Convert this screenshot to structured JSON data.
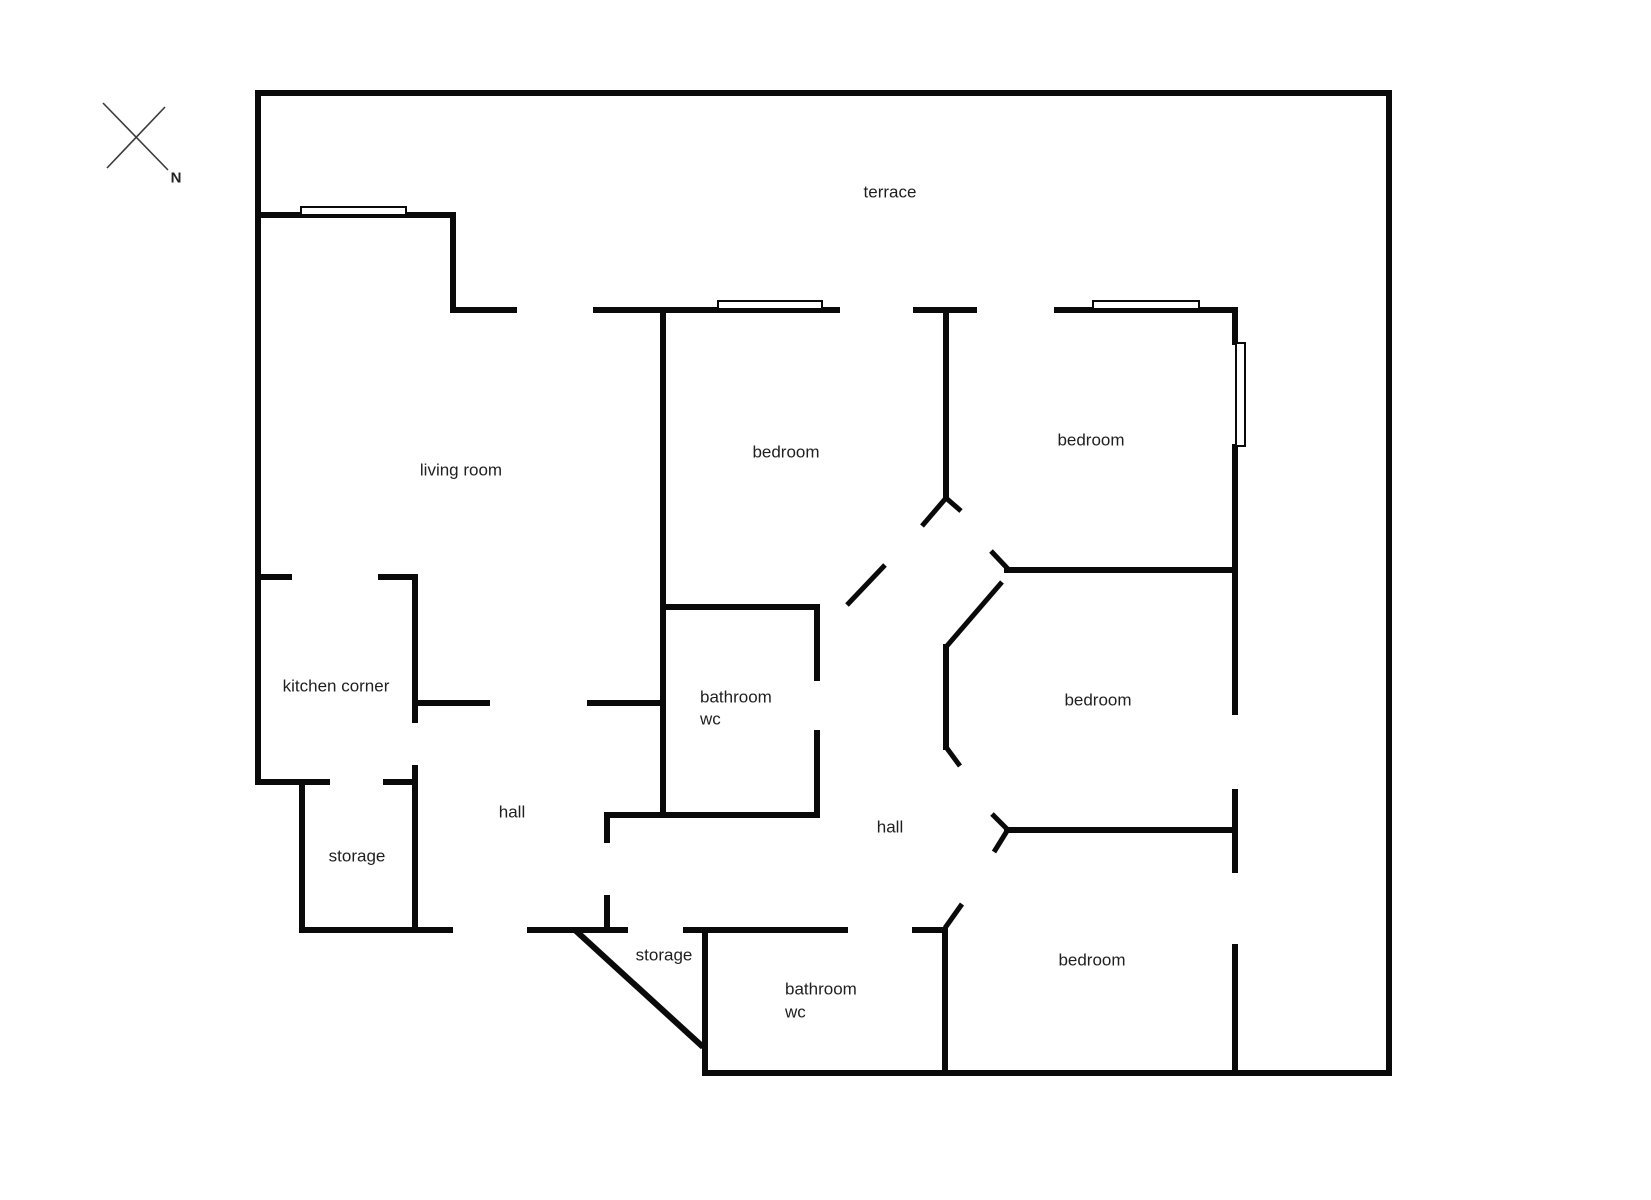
{
  "title": "apartment floor plan",
  "colors": {
    "wall": "#0a0a0a",
    "text": "#1f1f1f",
    "background": "#ffffff",
    "compass": "#3a3a3a"
  },
  "compass": {
    "label": "N",
    "label_cx": 176,
    "label_cy": 178,
    "lines": [
      {
        "x1": 103,
        "y1": 103,
        "x2": 168,
        "y2": 170
      },
      {
        "x1": 165,
        "y1": 107,
        "x2": 107,
        "y2": 168
      }
    ]
  },
  "labels": [
    {
      "name": "terrace",
      "text": "terrace",
      "cx": 890,
      "cy": 192,
      "align": "center"
    },
    {
      "name": "living-room",
      "text": "living room",
      "cx": 461,
      "cy": 470,
      "align": "center"
    },
    {
      "name": "bedroom-1",
      "text": "bedroom",
      "cx": 786,
      "cy": 452,
      "align": "center"
    },
    {
      "name": "bedroom-2",
      "text": "bedroom",
      "cx": 1091,
      "cy": 440,
      "align": "center"
    },
    {
      "name": "kitchen-corner",
      "text": "kitchen corner",
      "cx": 336,
      "cy": 686,
      "align": "center"
    },
    {
      "name": "bathroom-1-word",
      "text": "bathroom",
      "cx": 700,
      "cy": 697,
      "align": "left"
    },
    {
      "name": "bathroom-1-wc",
      "text": "wc",
      "cx": 700,
      "cy": 719,
      "align": "left"
    },
    {
      "name": "hall-1",
      "text": "hall",
      "cx": 512,
      "cy": 812,
      "align": "center"
    },
    {
      "name": "hall-2",
      "text": "hall",
      "cx": 890,
      "cy": 827,
      "align": "center"
    },
    {
      "name": "storage-1",
      "text": "storage",
      "cx": 357,
      "cy": 856,
      "align": "center"
    },
    {
      "name": "bedroom-3",
      "text": "bedroom",
      "cx": 1098,
      "cy": 700,
      "align": "center"
    },
    {
      "name": "storage-2",
      "text": "storage",
      "cx": 664,
      "cy": 955,
      "align": "center"
    },
    {
      "name": "bathroom-2-word",
      "text": "bathroom",
      "cx": 785,
      "cy": 989,
      "align": "left"
    },
    {
      "name": "bathroom-2-wc",
      "text": "wc",
      "cx": 785,
      "cy": 1012,
      "align": "left"
    },
    {
      "name": "bedroom-4",
      "text": "bedroom",
      "cx": 1092,
      "cy": 960,
      "align": "center"
    }
  ],
  "walls": [
    {
      "name": "outer-top",
      "x": 255,
      "y": 90,
      "w": 1137,
      "h": 6
    },
    {
      "name": "outer-left",
      "x": 255,
      "y": 90,
      "w": 6,
      "h": 695
    },
    {
      "name": "outer-right",
      "x": 1386,
      "y": 90,
      "w": 6,
      "h": 986
    },
    {
      "name": "outer-bottom",
      "x": 702,
      "y": 1070,
      "w": 690,
      "h": 6
    },
    {
      "name": "living-terrace-wall",
      "x": 255,
      "y": 212,
      "w": 201,
      "h": 6
    },
    {
      "name": "living-step-vertical",
      "x": 450,
      "y": 212,
      "w": 6,
      "h": 101
    },
    {
      "name": "living-top-stub",
      "x": 450,
      "y": 307,
      "w": 67,
      "h": 6
    },
    {
      "name": "bedroom1-top",
      "x": 593,
      "y": 307,
      "w": 247,
      "h": 6
    },
    {
      "name": "top-mid-stub",
      "x": 913,
      "y": 307,
      "w": 64,
      "h": 6
    },
    {
      "name": "bedroom2-top",
      "x": 1054,
      "y": 307,
      "w": 184,
      "h": 6
    },
    {
      "name": "kitchen-stub-left",
      "x": 255,
      "y": 574,
      "w": 37,
      "h": 6
    },
    {
      "name": "kitchen-stub-right",
      "x": 378,
      "y": 574,
      "w": 40,
      "h": 6
    },
    {
      "name": "kitchen-right-upper",
      "x": 412,
      "y": 574,
      "w": 6,
      "h": 149
    },
    {
      "name": "kitchen-right-lower",
      "x": 412,
      "y": 765,
      "w": 6,
      "h": 168
    },
    {
      "name": "kitchen-bottom-left",
      "x": 255,
      "y": 779,
      "w": 75,
      "h": 6
    },
    {
      "name": "kitchen-bottom-right",
      "x": 383,
      "y": 779,
      "w": 32,
      "h": 6
    },
    {
      "name": "storage1-left",
      "x": 299,
      "y": 779,
      "w": 6,
      "h": 154
    },
    {
      "name": "storage1-bottom",
      "x": 299,
      "y": 927,
      "w": 154,
      "h": 6
    },
    {
      "name": "hall1-top-left",
      "x": 414,
      "y": 700,
      "w": 76,
      "h": 6
    },
    {
      "name": "hall1-top-right",
      "x": 587,
      "y": 700,
      "w": 79,
      "h": 6
    },
    {
      "name": "hall1-bottom",
      "x": 527,
      "y": 927,
      "w": 101,
      "h": 6
    },
    {
      "name": "hall1-door-jamb-upper",
      "x": 604,
      "y": 812,
      "w": 6,
      "h": 31
    },
    {
      "name": "hall1-door-jamb-lower",
      "x": 604,
      "y": 895,
      "w": 6,
      "h": 38
    },
    {
      "name": "bathroom1-bottom",
      "x": 604,
      "y": 812,
      "w": 214,
      "h": 6
    },
    {
      "name": "bedroom1-left",
      "x": 660,
      "y": 307,
      "w": 6,
      "h": 511
    },
    {
      "name": "bathroom1-top",
      "x": 660,
      "y": 604,
      "w": 156,
      "h": 6
    },
    {
      "name": "bathroom1-right-upper",
      "x": 814,
      "y": 604,
      "w": 6,
      "h": 77
    },
    {
      "name": "bathroom1-right-lower",
      "x": 814,
      "y": 730,
      "w": 6,
      "h": 88
    },
    {
      "name": "bedroom1-right",
      "x": 943,
      "y": 307,
      "w": 6,
      "h": 193
    },
    {
      "name": "bedroom2-right-upper",
      "x": 1232,
      "y": 307,
      "w": 6,
      "h": 38
    },
    {
      "name": "bedroom2-right-lower",
      "x": 1232,
      "y": 444,
      "w": 6,
      "h": 129
    },
    {
      "name": "bedroom2-bottom",
      "x": 1004,
      "y": 567,
      "w": 234,
      "h": 6
    },
    {
      "name": "bedroom3-right-upper",
      "x": 1232,
      "y": 567,
      "w": 6,
      "h": 148
    },
    {
      "name": "bedroom3-right-lower",
      "x": 1232,
      "y": 789,
      "w": 6,
      "h": 44
    },
    {
      "name": "bedroom3-bottom",
      "x": 1004,
      "y": 827,
      "w": 234,
      "h": 6
    },
    {
      "name": "bedroom3-door-post",
      "x": 943,
      "y": 644,
      "w": 6,
      "h": 106
    },
    {
      "name": "bedroom4-right-upper",
      "x": 1232,
      "y": 827,
      "w": 6,
      "h": 46
    },
    {
      "name": "bedroom4-right-lower",
      "x": 1232,
      "y": 944,
      "w": 6,
      "h": 132
    },
    {
      "name": "bedroom4-left",
      "x": 942,
      "y": 927,
      "w": 6,
      "h": 146
    },
    {
      "name": "bedroom4-top-stub",
      "x": 912,
      "y": 927,
      "w": 36,
      "h": 6
    },
    {
      "name": "bathroom2-top",
      "x": 683,
      "y": 927,
      "w": 165,
      "h": 6
    },
    {
      "name": "bathroom2-left",
      "x": 702,
      "y": 927,
      "w": 6,
      "h": 149
    }
  ],
  "windows": [
    {
      "name": "window-living-room",
      "x": 300,
      "y": 206,
      "w": 107,
      "h": 10
    },
    {
      "name": "window-bedroom1",
      "x": 717,
      "y": 300,
      "w": 106,
      "h": 10
    },
    {
      "name": "window-bedroom2-top",
      "x": 1092,
      "y": 300,
      "w": 108,
      "h": 10
    },
    {
      "name": "window-bedroom2-right",
      "x": 1235,
      "y": 342,
      "w": 11,
      "h": 105
    }
  ],
  "door_marks": [
    {
      "name": "bedroom1-door-swing",
      "x1": 847,
      "y1": 605,
      "x2": 885,
      "y2": 565,
      "t": 5
    },
    {
      "name": "bedroom1-jamb-tick-left",
      "x1": 946,
      "y1": 498,
      "x2": 922,
      "y2": 526,
      "t": 5
    },
    {
      "name": "bedroom1-jamb-tick-right",
      "x1": 946,
      "y1": 498,
      "x2": 961,
      "y2": 511,
      "t": 5
    },
    {
      "name": "bedroom2-jamb-tick",
      "x1": 1008,
      "y1": 569,
      "x2": 991,
      "y2": 551,
      "t": 5
    },
    {
      "name": "bedroom3-door-swing-upper",
      "x1": 1002,
      "y1": 582,
      "x2": 946,
      "y2": 647,
      "t": 5
    },
    {
      "name": "bedroom3-door-swing-lower",
      "x1": 946,
      "y1": 747,
      "x2": 960,
      "y2": 766,
      "t": 5
    },
    {
      "name": "bedroom3-jamb-tick-up",
      "x1": 1007,
      "y1": 829,
      "x2": 992,
      "y2": 814,
      "t": 5
    },
    {
      "name": "bedroom3-jamb-tick-down",
      "x1": 1007,
      "y1": 831,
      "x2": 994,
      "y2": 852,
      "t": 5
    },
    {
      "name": "bathroom2-door-tick",
      "x1": 945,
      "y1": 928,
      "x2": 962,
      "y2": 904,
      "t": 5
    },
    {
      "name": "storage2-diagonal-wall",
      "x1": 575,
      "y1": 930,
      "x2": 703,
      "y2": 1047,
      "t": 6
    }
  ]
}
